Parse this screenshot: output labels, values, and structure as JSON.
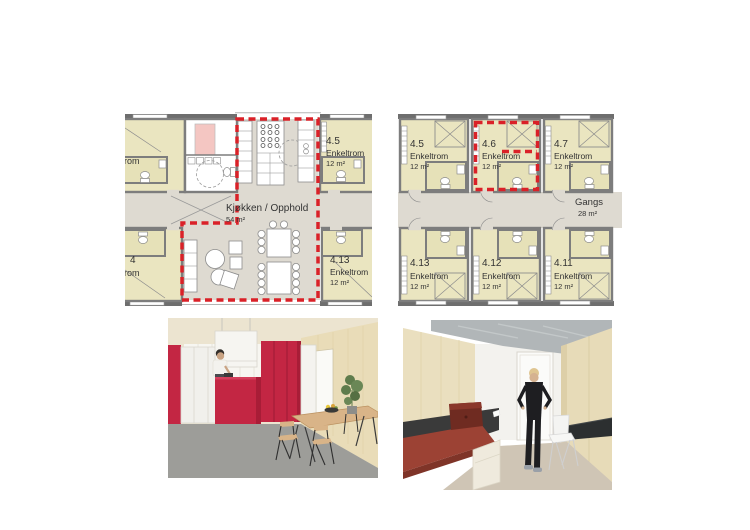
{
  "colors": {
    "plan_room_fill": "#eae5c0",
    "plan_common_fill": "#dedad1",
    "plan_wall": "#7d7d7d",
    "highlight_red": "#da2128",
    "plan_accent_pink": "#f4c6c2",
    "render_cabinet_red": "#c32643",
    "render_bed_red": "#9c4234"
  },
  "plans": {
    "left": {
      "common_room": {
        "label": "Kjøkken / Opphold",
        "area": "54 m²"
      },
      "room_top_left": {
        "type": "Enkeltrom"
      },
      "room_top_right": {
        "number": "4.5",
        "type": "Enkeltrom",
        "area": "12 m²"
      },
      "room_bottom_left": {
        "number": "4",
        "type": "Enkeltrom"
      },
      "room_bottom_right": {
        "number": "4.13",
        "type": "Enkeltrom",
        "area": "12 m²"
      }
    },
    "right": {
      "corridor": {
        "label": "Gangs",
        "area": "28 m²"
      },
      "highlighted_room": "4.6",
      "rooms_top": [
        {
          "number": "4.5",
          "type": "Enkeltrom",
          "area": "12 m²"
        },
        {
          "number": "4.6",
          "type": "Enkeltrom",
          "area": "12 m²"
        },
        {
          "number": "4.7",
          "type": "Enkeltrom",
          "area": "12 m²"
        }
      ],
      "rooms_bottom": [
        {
          "number": "4.13",
          "type": "Enkeltrom",
          "area": "12 m²"
        },
        {
          "number": "4.12",
          "type": "Enkeltrom",
          "area": "12 m²"
        },
        {
          "number": "4.11",
          "type": "Enkeltrom",
          "area": "12 m²"
        }
      ]
    }
  }
}
